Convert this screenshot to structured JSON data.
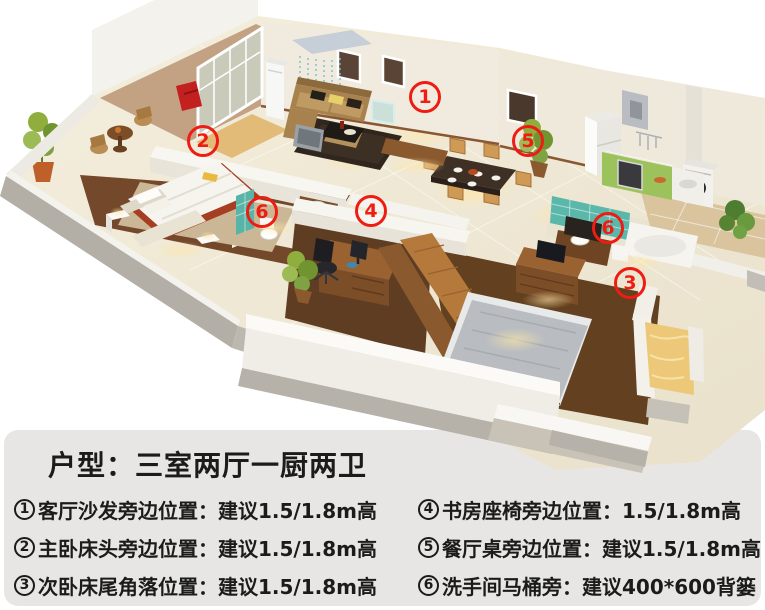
{
  "theme": {
    "marker_red": "#ee1c12",
    "panel_bg": "#e7e6e4",
    "text_dark": "#1b1b1b"
  },
  "floorplan": {
    "alt": "3D isometric apartment floor plan render",
    "markers": [
      {
        "num": "1",
        "x": 425,
        "y": 97
      },
      {
        "num": "2",
        "x": 203,
        "y": 141
      },
      {
        "num": "3",
        "x": 630,
        "y": 283
      },
      {
        "num": "4",
        "x": 371,
        "y": 211
      },
      {
        "num": "5",
        "x": 528,
        "y": 141
      },
      {
        "num": "6",
        "x": 262,
        "y": 212
      },
      {
        "num": "6",
        "x": 608,
        "y": 228
      }
    ]
  },
  "panel": {
    "title": "户型：三室两厅一厨两卫",
    "items_left": [
      {
        "num": "1",
        "text": "客厅沙发旁边位置：建议1.5/1.8m高"
      },
      {
        "num": "2",
        "text": "主卧床头旁边位置：建议1.5/1.8m高"
      },
      {
        "num": "3",
        "text": "次卧床尾角落位置：建议1.5/1.8m高"
      }
    ],
    "items_right": [
      {
        "num": "4",
        "text": "书房座椅旁边位置：1.5/1.8m高"
      },
      {
        "num": "5",
        "text": "餐厅桌旁边位置：建议1.5/1.8m高"
      },
      {
        "num": "6",
        "text": "洗手间马桶旁：建议400*600背篓"
      }
    ]
  }
}
